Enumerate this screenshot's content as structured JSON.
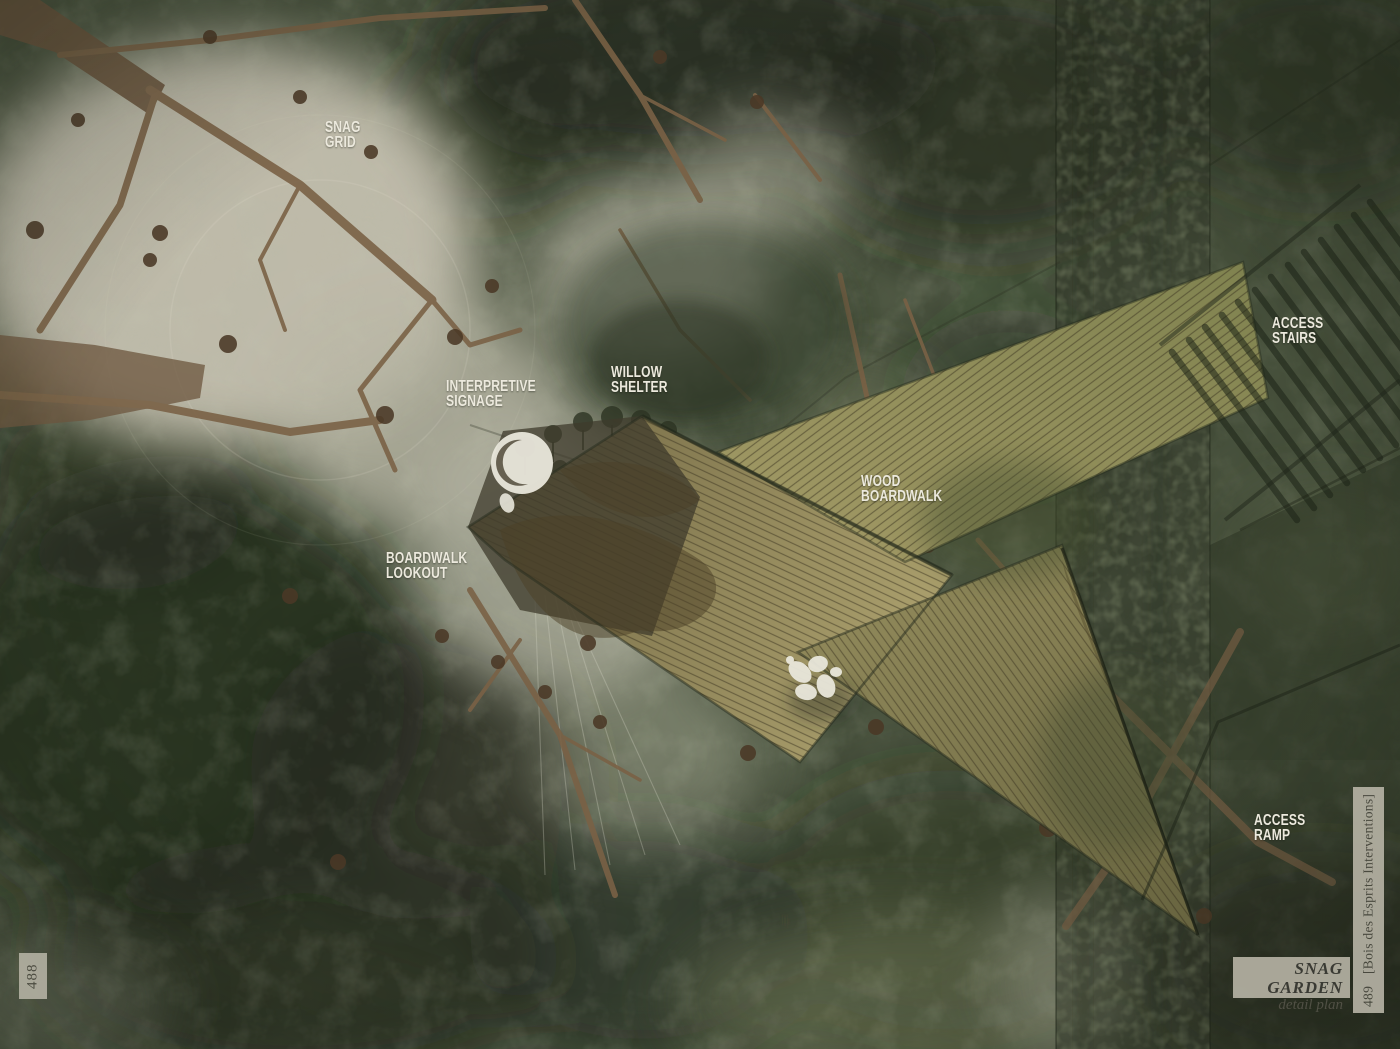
{
  "page": {
    "left_page_number": "488",
    "right_page_number": "489",
    "right_margin_text": "[Bois des Esprits Interventions]",
    "title": "SNAG GARDEN",
    "subtitle": "detail plan"
  },
  "plan_labels": [
    {
      "id": "snag-grid",
      "lines": [
        "SNAG",
        "GRID"
      ]
    },
    {
      "id": "interpretive-signage",
      "lines": [
        "INTERPRETIVE",
        "SIGNAGE"
      ]
    },
    {
      "id": "willow-shelter",
      "lines": [
        "WILLOW",
        "SHELTER"
      ]
    },
    {
      "id": "wood-boardwalk",
      "lines": [
        "WOOD",
        "BOARDWALK"
      ]
    },
    {
      "id": "access-stairs",
      "lines": [
        "ACCESS",
        "STAIRS"
      ]
    },
    {
      "id": "boardwalk-lookout",
      "lines": [
        "BOARDWALK",
        "LOOKOUT"
      ]
    },
    {
      "id": "access-ramp",
      "lines": [
        "ACCESS",
        "RAMP"
      ]
    }
  ],
  "colors": {
    "label_text": "#ece9dd",
    "canopy_base": "#47503c",
    "canopy_dark": "#232a1c",
    "clearing_light": "#c3bfae",
    "branch_brown": "#7a6146",
    "boardwalk_tan": "#a2986a",
    "boardwalk_dark_wood": "#4c3f25",
    "figure_white": "#e9e7db",
    "tab_background": "#b4b1a3",
    "tab_text": "#4c4b41",
    "title_text": "#3c3c36"
  }
}
